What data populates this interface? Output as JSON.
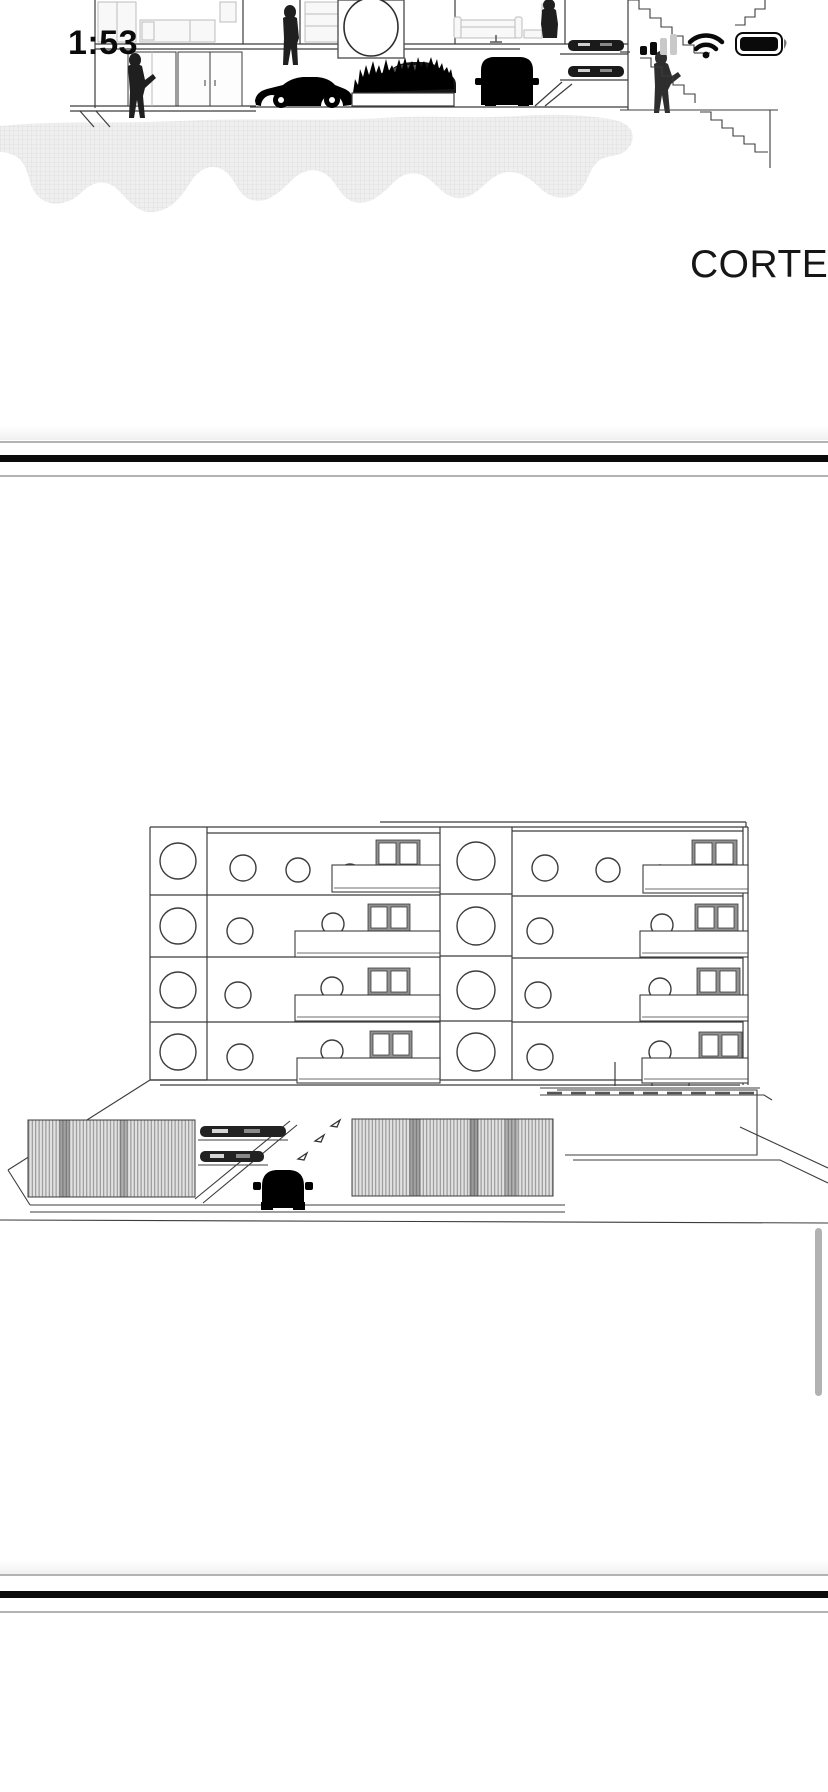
{
  "status_bar": {
    "time": "1:53",
    "signal_icon": "cellular-signal-2-of-4-bars",
    "wifi_icon": "wifi-full",
    "battery_icon": "battery-full"
  },
  "document": {
    "page1_caption": "CORTE",
    "page2_caption": "FACHADA FRONTAL"
  },
  "colors": {
    "background": "#ffffff",
    "ink": "#3c3c3c",
    "silhouette": "#1f1f1f",
    "furniture": "#bdbdbd",
    "divider_thin": "#b3b3b3",
    "divider_thick": "#0b0b0b",
    "ground_hatch_fill": "#efefef",
    "ground_hatch_line": "#dcdcdc",
    "louver_fill": "#e2e2e2",
    "louver_line": "#8a8a8a",
    "window_frame": "#909090",
    "scrollbar": "rgba(0,0,0,0.30)"
  }
}
